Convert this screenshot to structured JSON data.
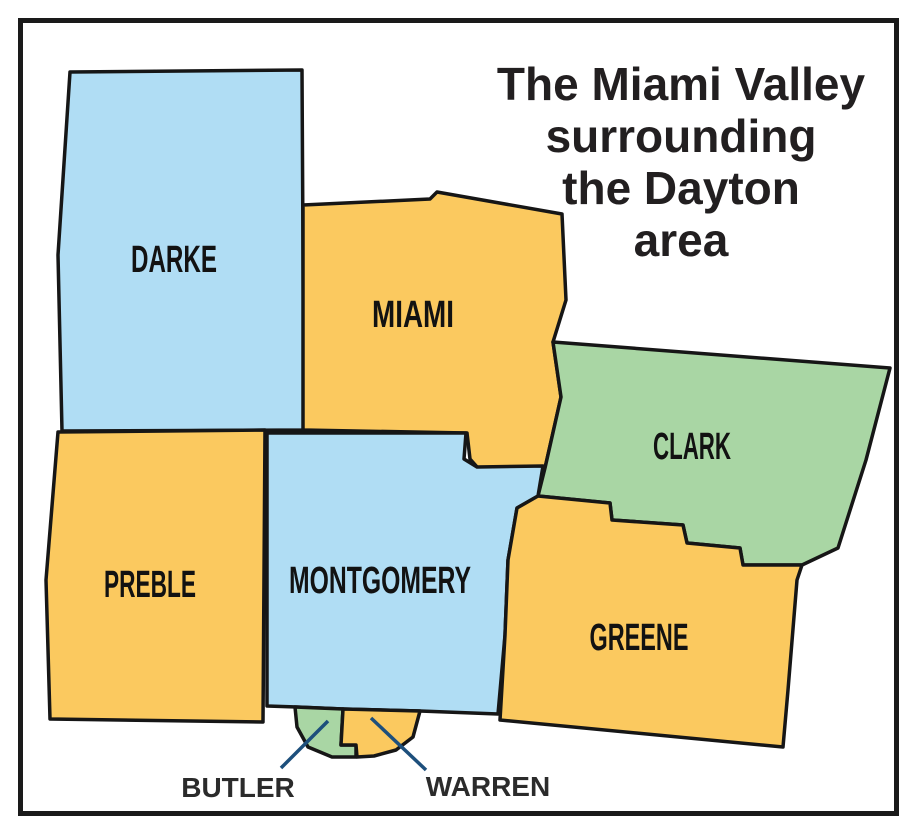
{
  "title": {
    "lines": [
      "The Miami Valley",
      "surrounding",
      "the Dayton",
      "area"
    ],
    "x": 681,
    "first_baseline": 100,
    "line_step": 52
  },
  "palette": {
    "background": "#ffffff",
    "frame": "#1a1a1a",
    "outline": "#161616",
    "leader_line": "#1d4f7c",
    "blue": "#b0ddf4",
    "orange": "#fbc95f",
    "green": "#a9d6a4"
  },
  "map": {
    "counties": [
      {
        "name": "darke",
        "label": "DARKE",
        "fill_key": "blue",
        "points": "70,72 302,70 304,430 62,431 58,255",
        "label_x": 174,
        "label_y": 272,
        "label_size": 38,
        "label_length": 86
      },
      {
        "name": "miami",
        "label": "MIAMI",
        "fill_key": "orange",
        "points": "303,205 430,199 437,192 562,214 566,300 553,342 561,397 545,468 478,468 470,459 467,433 303,430",
        "label_x": 413,
        "label_y": 327,
        "label_size": 38,
        "label_length": 82
      },
      {
        "name": "clark",
        "label": "CLARK",
        "fill_key": "green",
        "points": "553,342 890,368 866,460 838,548 802,565 743,565 740,548 687,543 683,525 612,520 610,503 538,496 545,468 561,397",
        "label_x": 692,
        "label_y": 459,
        "label_size": 38,
        "label_length": 78
      },
      {
        "name": "preble",
        "label": "PREBLE",
        "fill_key": "orange",
        "points": "58,432 265,430 263,722 50,719 46,580",
        "label_x": 150,
        "label_y": 597,
        "label_size": 38,
        "label_length": 92
      },
      {
        "name": "montgomery",
        "label": "MONTGOMERY",
        "fill_key": "blue",
        "points": "267,433 466,433 464,459 477,467 543,466 538,496 517,508 508,560 505,635 498,714 420,711 343,709 297,707 267,706",
        "label_x": 380,
        "label_y": 593,
        "label_size": 38,
        "label_length": 182
      },
      {
        "name": "greene",
        "label": "GREENE",
        "fill_key": "orange",
        "points": "517,508 538,496 610,503 612,520 683,525 687,543 740,548 743,565 802,565 797,580 788,690 783,747 500,720 505,635 508,560",
        "label_x": 639,
        "label_y": 650,
        "label_size": 38,
        "label_length": 99
      },
      {
        "name": "butler",
        "label": "",
        "fill_key": "green",
        "points": "295,707 343,709 341,745 356,745 356,757 332,757 308,747 297,727",
        "label_x": 0,
        "label_y": 0,
        "label_size": 0,
        "label_length": 0
      },
      {
        "name": "warren",
        "label": "",
        "fill_key": "orange",
        "points": "343,709 420,711 413,737 396,750 374,756 357,757 356,745 341,745",
        "label_x": 0,
        "label_y": 0,
        "label_size": 0,
        "label_length": 0
      }
    ],
    "callouts": [
      {
        "name": "butler",
        "label": "BUTLER",
        "line": {
          "x1": 328,
          "y1": 721,
          "x2": 281,
          "y2": 768
        },
        "label_x": 238,
        "label_y": 797
      },
      {
        "name": "warren",
        "label": "WARREN",
        "line": {
          "x1": 371,
          "y1": 718,
          "x2": 426,
          "y2": 770
        },
        "label_x": 488,
        "label_y": 796
      }
    ]
  }
}
